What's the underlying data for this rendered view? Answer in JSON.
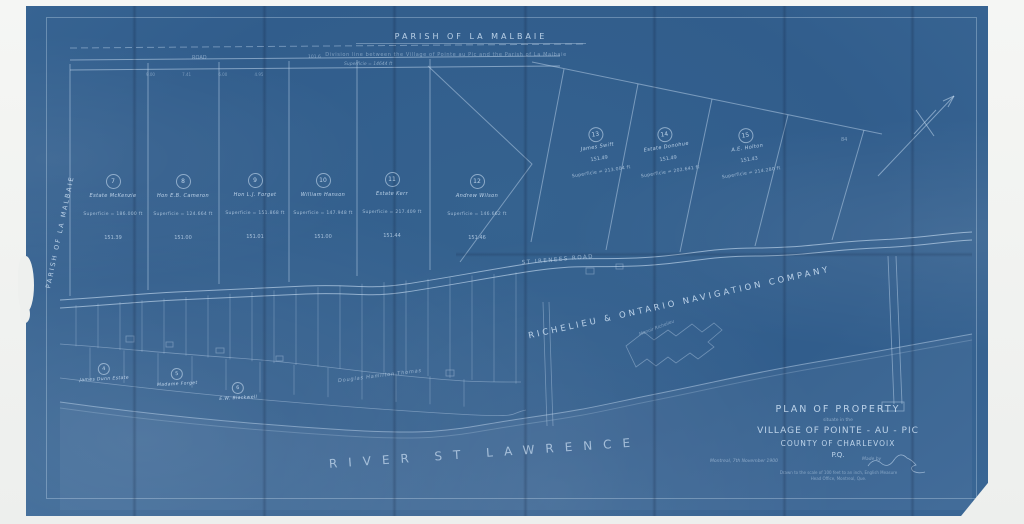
{
  "map": {
    "top_parish_label": "PARISH OF LA MALBAIE",
    "division_note": "Division line between the Village of Pointe au Pic and the Parish of La Malbaie",
    "left_parish_label": "PARISH OF LA MALBAIE",
    "top_road_label": "ROAD",
    "top_road_number": "101.6",
    "top_superficie": "Superficie = 14644 ft",
    "top_ticks_row": "9.00   7.41   6.00   4.95",
    "st_irenee_road_label": "ST IRENEES ROAD",
    "company_label": "RICHELIEU & ONTARIO NAVIGATION COMPANY",
    "hotel_label": "Manoir Richelieu",
    "river_label": "RIVER ST LAWRENCE",
    "thomas_label": "Douglas Hamilton Thomas",
    "area_number": "84"
  },
  "upper_lots": [
    {
      "num": "7",
      "owner": "Estate McKenzie",
      "superficie": "Superficie = 186.000 ft",
      "dim": "151.39"
    },
    {
      "num": "8",
      "owner": "Hon E.B. Cameron",
      "superficie": "Superficie = 124.664 ft",
      "dim": "151.00"
    },
    {
      "num": "9",
      "owner": "Hon L.J. Forget",
      "superficie": "Superficie = 151.868 ft",
      "dim": "151.01"
    },
    {
      "num": "10",
      "owner": "William Hanson",
      "superficie": "Superficie = 147.948 ft",
      "dim": "151.00"
    },
    {
      "num": "11",
      "owner": "Estate Kerr",
      "superficie": "Superficie = 217.409 ft",
      "dim": "151.44"
    },
    {
      "num": "12",
      "owner": "Andrew Wilson",
      "superficie": "Superficie = 146.662 ft",
      "dim": "151.46"
    }
  ],
  "right_lots": [
    {
      "num": "13",
      "owner": "James Swift",
      "dim": "151.49",
      "superficie": "Superficie = 213.004 ft"
    },
    {
      "num": "14",
      "owner": "Estate Donohue",
      "dim": "151.49",
      "superficie": "Superficie = 202.641 ft"
    },
    {
      "num": "15",
      "owner": "A.E. Holton",
      "dim": "151.43",
      "superficie": "Superficie = 214.280 ft"
    }
  ],
  "lower_lots": [
    {
      "num": "4",
      "owner": "James Dunn Estate"
    },
    {
      "num": "5",
      "owner": "Madame Forget"
    },
    {
      "num": "6",
      "owner": "E.W. Blackwell"
    }
  ],
  "title_block": {
    "line1": "PLAN OF PROPERTY",
    "line2": "situate in the",
    "line3": "VILLAGE OF POINTE - AU - PIC",
    "line4": "COUNTY OF CHARLEVOIX",
    "line5": "P.Q.",
    "date": "Montreal, 7th November 1900",
    "made_by": "Made by",
    "scale_note": "Drawn to the scale of 100 feet to an inch, English Measure",
    "office_note": "Head Office, Montreal, Que."
  },
  "colors": {
    "paper_blue": "#336190",
    "line_white": "#cfe3f7",
    "text_white": "#d6e8fa"
  }
}
